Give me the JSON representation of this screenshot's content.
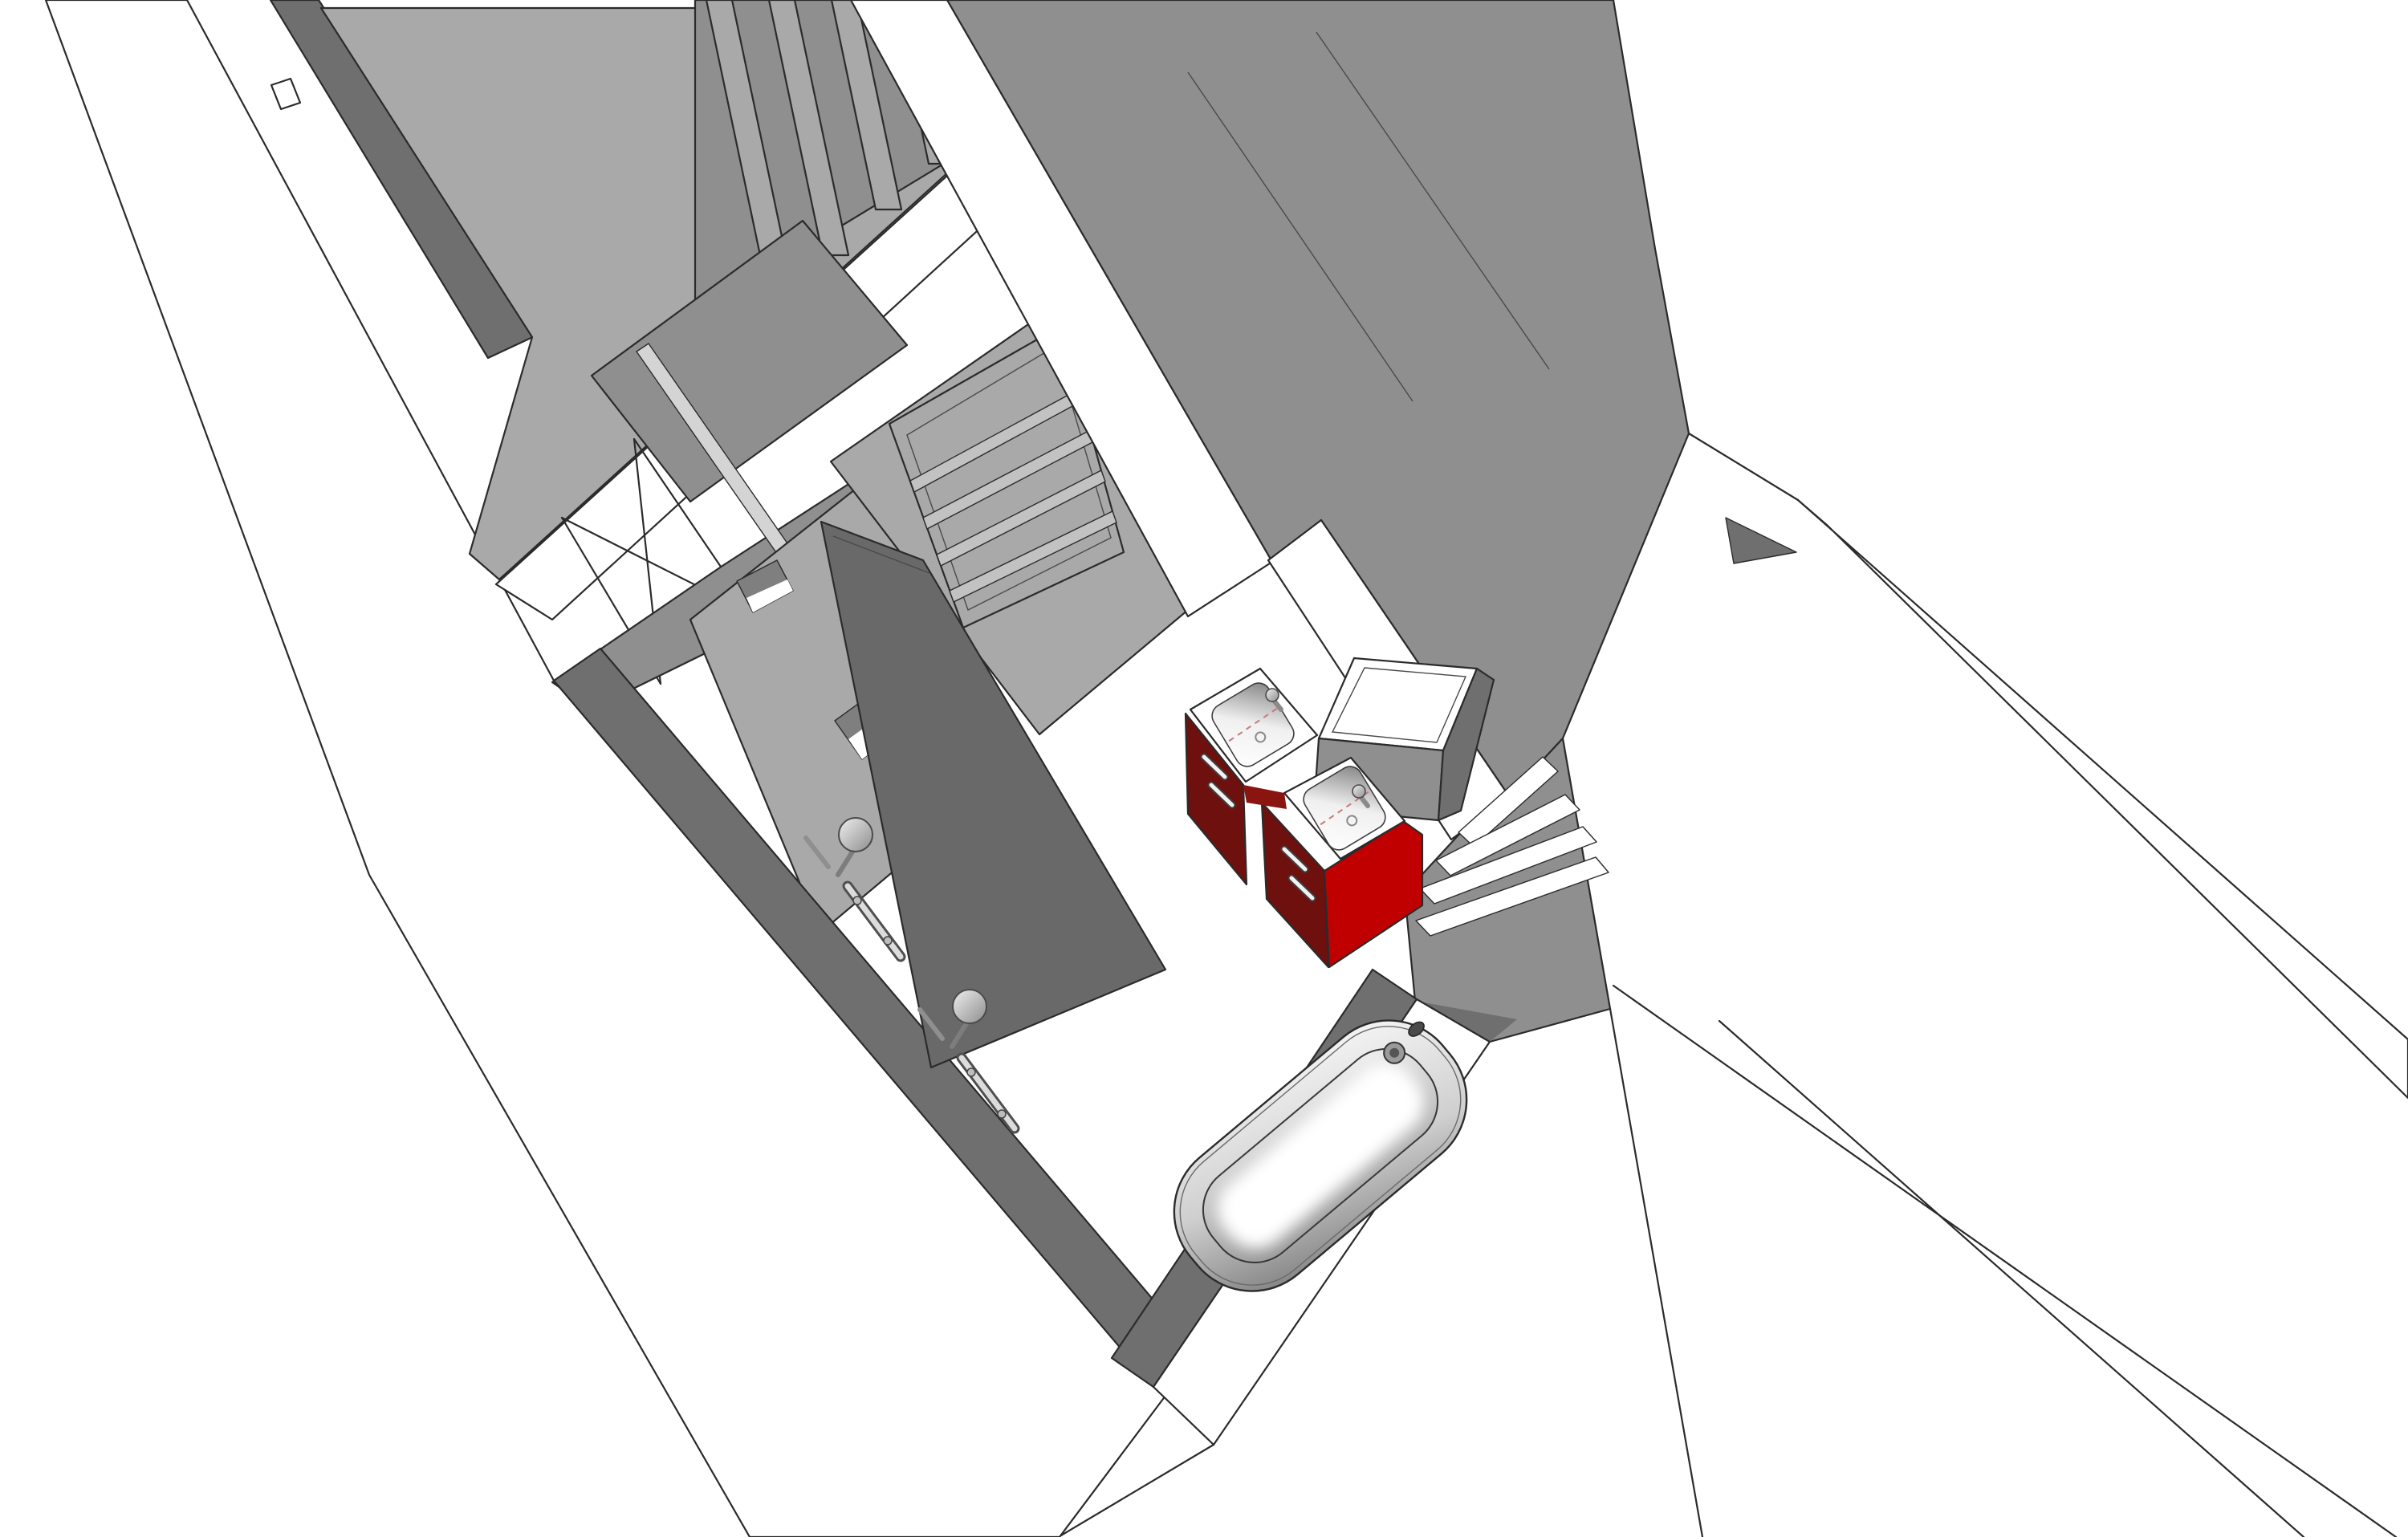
{
  "viewport": {
    "kind": "3d-model-render",
    "style": "hidden-line shaded, top-down oblique perspective",
    "subject": "apartment bathroom section with adjacent room, wardrobe, corridor and staircase"
  },
  "colors": {
    "white": "#ffffff",
    "line": "#2b2b2b",
    "face_light": "#a9a9a9",
    "face_mid": "#8f8f8f",
    "face_dark": "#6f6f6f",
    "glass": "#696969",
    "glass_edge": "#d4d4d4",
    "door_slat": "#c2c2c2",
    "red_front": "#6e100d",
    "red_side": "#c00000",
    "red_sliver": "#8a1410",
    "chrome_light": "#dcdcdc",
    "chrome_mid": "#9c9c9c",
    "niche_shade": "#7f7f7f",
    "stair_dark": "#6f6f6f"
  },
  "objects": {
    "room_floor": "adjacent room floor slab",
    "wardrobe": "sliding wardrobe panels",
    "void_brace": "cross-braced void opening",
    "door": "interior door with four slats",
    "glass_screen": "shower glass partition",
    "niche_upper": "wall niche with hatched top",
    "niche_lower": "wall niche near shower",
    "shower_set_1": "thermostatic shower column 1",
    "shower_set_2": "thermostatic shower column 2",
    "vanity_sink_1": "washbasin unit 1 on red cabinet",
    "vanity_sink_2": "washbasin unit 2 on red cabinet",
    "tall_cabinet": "tall storage cabinet",
    "bathtub": "built-in bathtub with drain and filler",
    "staircase": "staircase treads beside bathroom",
    "walls": "cut wall tops shown white, faces shaded grey"
  }
}
